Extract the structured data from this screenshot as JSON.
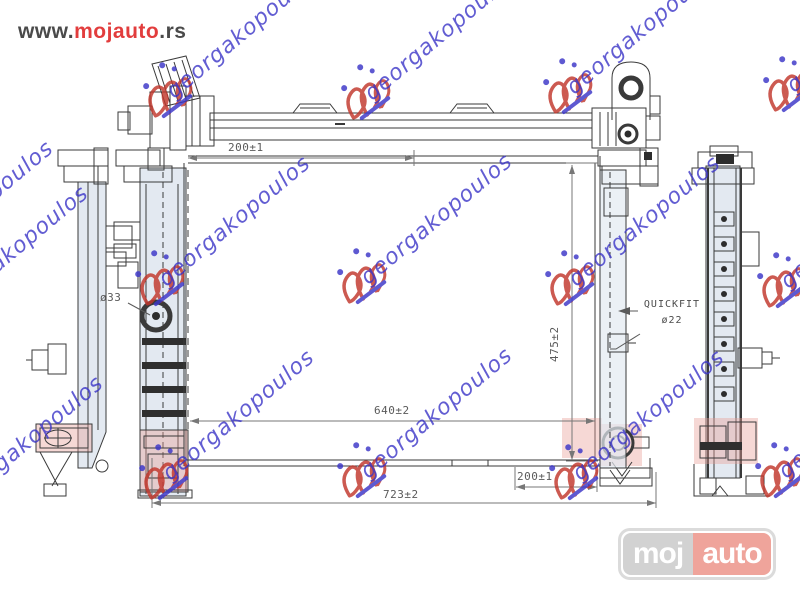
{
  "header": {
    "prefix": "www.",
    "brand": "mojauto",
    "suffix": ".rs"
  },
  "drawing": {
    "labels": {
      "top_width": "200±1",
      "height": "475±2",
      "core_width": "640±2",
      "overall_width": "723±2",
      "bottom_offset": "200±1",
      "quickfit": "QUICKFIT",
      "quickfit_dia": "ø22",
      "inlet_dia": "ø33"
    }
  },
  "watermark": {
    "text": "georgakopoulos",
    "blue": "#3b35c8",
    "red": "#c2362b",
    "stamps": [
      {
        "x": 140,
        "y": 58
      },
      {
        "x": 338,
        "y": 60
      },
      {
        "x": 540,
        "y": 54
      },
      {
        "x": 760,
        "y": 52
      },
      {
        "x": 132,
        "y": 246
      },
      {
        "x": 334,
        "y": 244
      },
      {
        "x": 542,
        "y": 246
      },
      {
        "x": 754,
        "y": 248
      },
      {
        "x": 136,
        "y": 440
      },
      {
        "x": 334,
        "y": 438
      },
      {
        "x": 546,
        "y": 440
      },
      {
        "x": 752,
        "y": 438
      }
    ],
    "tails": [
      {
        "x": -95,
        "y": 255
      },
      {
        "x": -60,
        "y": 300
      },
      {
        "x": -45,
        "y": 490
      }
    ]
  },
  "footer_logo": {
    "left": "moj",
    "right": "auto"
  }
}
